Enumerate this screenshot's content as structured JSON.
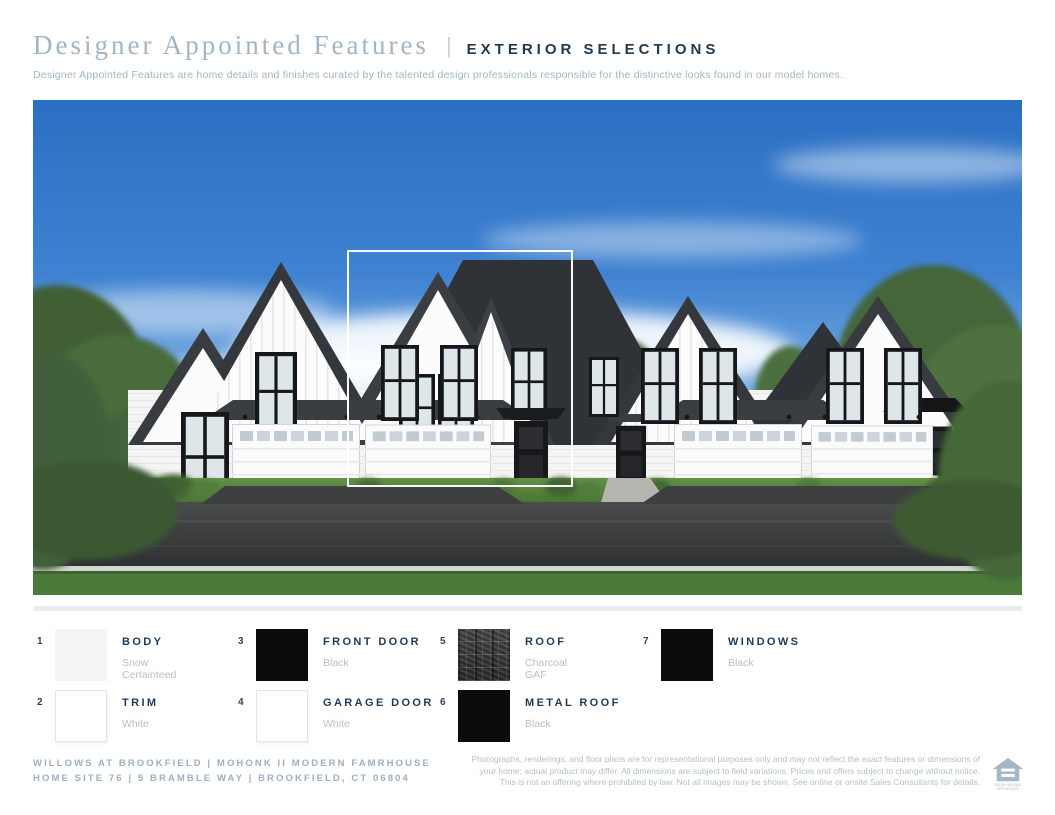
{
  "header": {
    "title": "Designer Appointed Features",
    "separator": "|",
    "section": "EXTERIOR SELECTIONS",
    "description": "Designer Appointed Features are home details and finishes curated by the talented design professionals responsible for the distinctive looks found in our model homes."
  },
  "selections": [
    {
      "num": "1",
      "label": "BODY",
      "value1": "Snow",
      "value2": "Certainteed",
      "swatch": "snow"
    },
    {
      "num": "2",
      "label": "TRIM",
      "value1": "White",
      "value2": "",
      "swatch": "white"
    },
    {
      "num": "3",
      "label": "FRONT DOOR",
      "value1": "Black",
      "value2": "",
      "swatch": "black"
    },
    {
      "num": "4",
      "label": "GARAGE DOOR",
      "value1": "White",
      "value2": "",
      "swatch": "white"
    },
    {
      "num": "5",
      "label": "ROOF",
      "value1": "Charcoal",
      "value2": "GAF",
      "swatch": "shingle"
    },
    {
      "num": "6",
      "label": "METAL ROOF",
      "value1": "Black",
      "value2": "",
      "swatch": "black"
    },
    {
      "num": "7",
      "label": "WINDOWS",
      "value1": "Black",
      "value2": "",
      "swatch": "black"
    }
  ],
  "footer": {
    "community_line1": "WILLOWS AT BROOKFIELD  |  MOHONK II MODERN FAMRHOUSE",
    "community_line2": "HOME SITE 76  |  5 BRAMBLE WAY  |  BROOKFIELD, CT 06804",
    "disclaimer_line1": "Photographs, renderings, and floor plans are for representational purposes only and may not reflect the exact features or dimensions of",
    "disclaimer_line2": "your home; actual product may differ. All dimensions are subject to field variations. Prices and offers subject to change without notice.",
    "disclaimer_line3": "This is not an offering where prohibited by law. Not all images may be shown. See online or onsite Sales Consultants for details.",
    "eho_line1": "EQUAL HOUSING",
    "eho_line2": "OPPORTUNITY"
  },
  "colors": {
    "accent_navy": "#24384e",
    "title_slate": "#a3b4c3",
    "muted_value_text": "#b7c0c6",
    "footer_slate": "#9db0c0",
    "divider_bar": "#e7edee",
    "swatch_snow": "#f4f4f3",
    "swatch_black": "#0a0b0c",
    "roof_charcoal": "#3a3d40",
    "highlight_outline": "#ffffff"
  }
}
